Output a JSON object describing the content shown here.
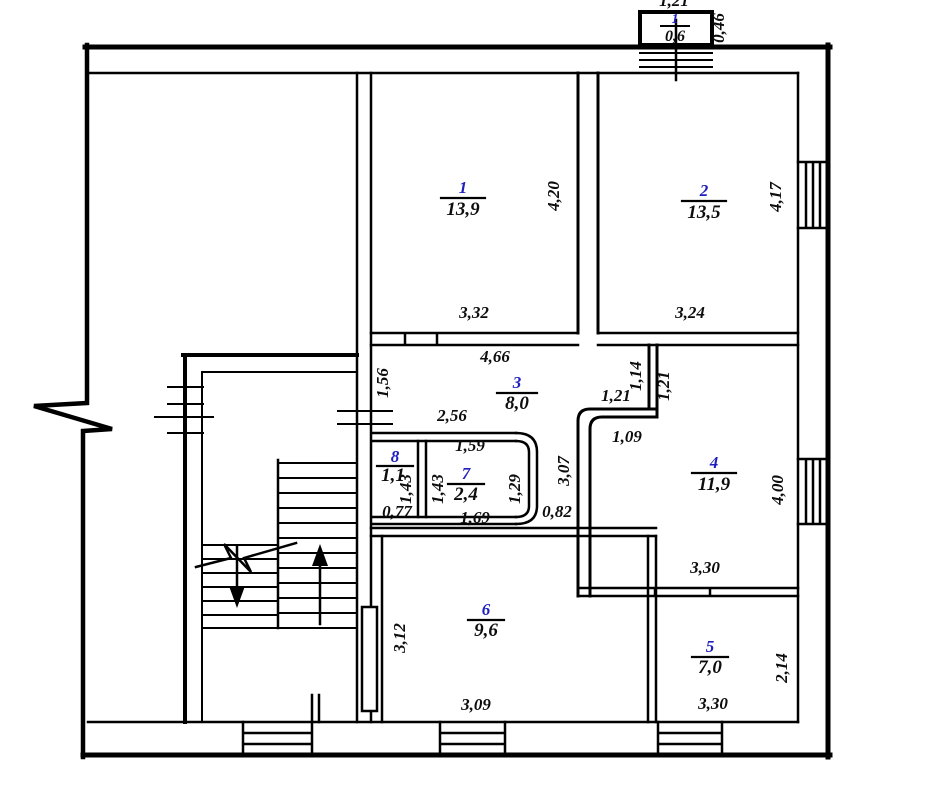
{
  "plan_type": "floor-plan",
  "colors": {
    "wall": "#000000",
    "room_number": "#1f1fbe",
    "label": "#0d0d0d",
    "background": "#ffffff"
  },
  "rooms": [
    {
      "number": "1",
      "area": "13,9",
      "width": "3,32",
      "height": "4,20"
    },
    {
      "number": "2",
      "area": "13,5",
      "width": "3,24",
      "height": "4,17"
    },
    {
      "number": "3",
      "area": "8,0",
      "top": "4,66",
      "left": "1,56",
      "inner": "2,56",
      "nook_width": "1,21",
      "door": "1,14",
      "nook_height": "1,21",
      "bottom": "1,09"
    },
    {
      "number": "4",
      "area": "11,9",
      "width": "3,30",
      "height": "4,00"
    },
    {
      "number": "5",
      "area": "7,0",
      "width": "3,30",
      "height": "2,14"
    },
    {
      "number": "6",
      "area": "9,6",
      "width": "3,09",
      "height": "3,12"
    },
    {
      "number": "7",
      "area": "2,4",
      "top": "1,59",
      "left": "1,43",
      "right": "1,29",
      "bottom": "1,69"
    },
    {
      "number": "8",
      "area": "1,1",
      "width": "0,77",
      "height": "1,43"
    }
  ],
  "balcony": {
    "number": "1",
    "area": "0,6",
    "wall": "0,46",
    "top": "1,21"
  },
  "passage": {
    "width": "0,82",
    "length": "3,07"
  }
}
